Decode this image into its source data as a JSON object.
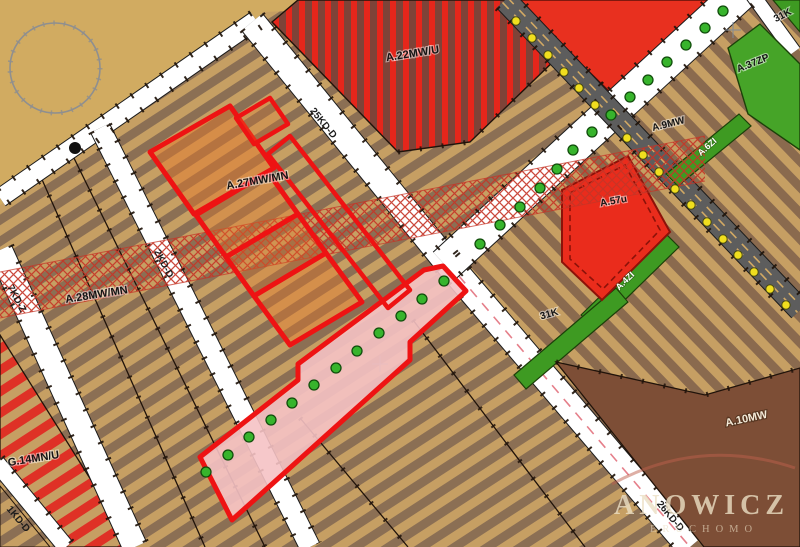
{
  "map": {
    "labels": {
      "a22": "A.22MW/U",
      "k31_top": "31K",
      "a37zp": "A.37ZP",
      "a9mw": "A.9MW",
      "a6zi": "A.6ZI",
      "a57u": "A.57u",
      "a4zi": "A.4ZI",
      "k31_mid": "31K",
      "a27": "A.27MW/MN",
      "kd25": "25KD-D",
      "kd2": "2KD-D",
      "kd7": "7KD-Z",
      "a28": "A.28MW/MN",
      "g14": "G.14MN/U",
      "kd1": "1KD-D",
      "a10mw": "A.10MW",
      "kd26": "26KD-D"
    },
    "watermark": {
      "main": "ANOWICZ",
      "sub": "ERUCHOMO"
    },
    "palette": {
      "land_tan": "#d1ab61",
      "parcel_tan": "#c69f63",
      "parcel_brown": "#8b6f54",
      "zone_red": "#e8301f",
      "zone_red_stripe_bg": "#7e4338",
      "zone_green": "#3e9a22",
      "road_gray": "#5d5d5d",
      "highlight_pink": "#f5c2c4",
      "highlight_red": "#ee1313",
      "crosshatch_red": "#c53527",
      "tree_dot": "#37b42c",
      "lamp_dot": "#f0de1e"
    }
  }
}
